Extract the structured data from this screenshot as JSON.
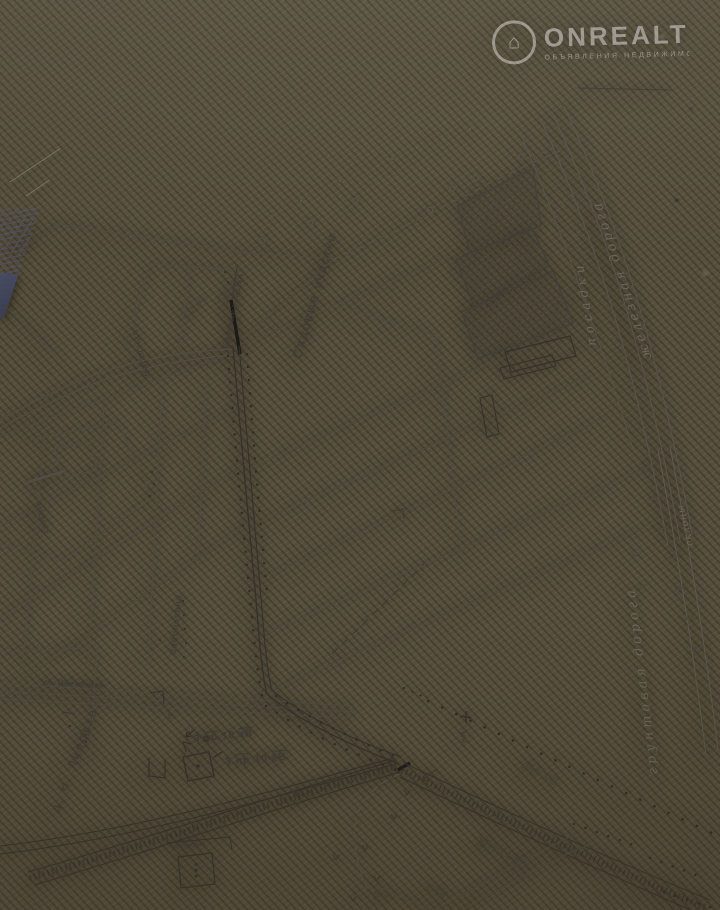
{
  "watermark": {
    "brand": "ONREALT",
    "tagline": "ОБЪЯВЛЕНИЯ НЕДВИЖИМОСТИ",
    "icon": "house-icon"
  },
  "labels": {
    "nasosnaya": "Насосная",
    "sadovye_uchastki_small": "Садовые участки",
    "sadovye_uchastki_large": "Садовые участки",
    "area_1": "2,2 га.",
    "area_2": "2,2 га.",
    "yemkost": "Емкость",
    "zabolochena": "Заболочена",
    "ul_tsvetochnaya": "ул. Цветочная",
    "village": "д. Н. Липовка",
    "tr": "тр",
    "mn": "мн",
    "power_10kv_1": {
      "qty": "3",
      "wire": "пр",
      "num": "10",
      "volt": "кВ"
    },
    "power_10kv_2": {
      "qty": "3",
      "wire": "пр",
      "num": "10",
      "volt": "кВ"
    },
    "power_6kv": "Эл. 6кВ",
    "power_110kv": {
      "wire": "пр",
      "num": "110",
      "volt": "кВ"
    },
    "yul": "Ю.Л.",
    "posadki": "посадки",
    "zheleznaya_doroga": "железная дорога",
    "sklony": "склоны",
    "gruntovaya_doroga": "грунтовая дорога",
    "ul_lugovaya": "ул. Луговая",
    "vod": "вод",
    "hatch_note_1": "0,10 га",
    "hatch_note_2": "0,14 га"
  }
}
